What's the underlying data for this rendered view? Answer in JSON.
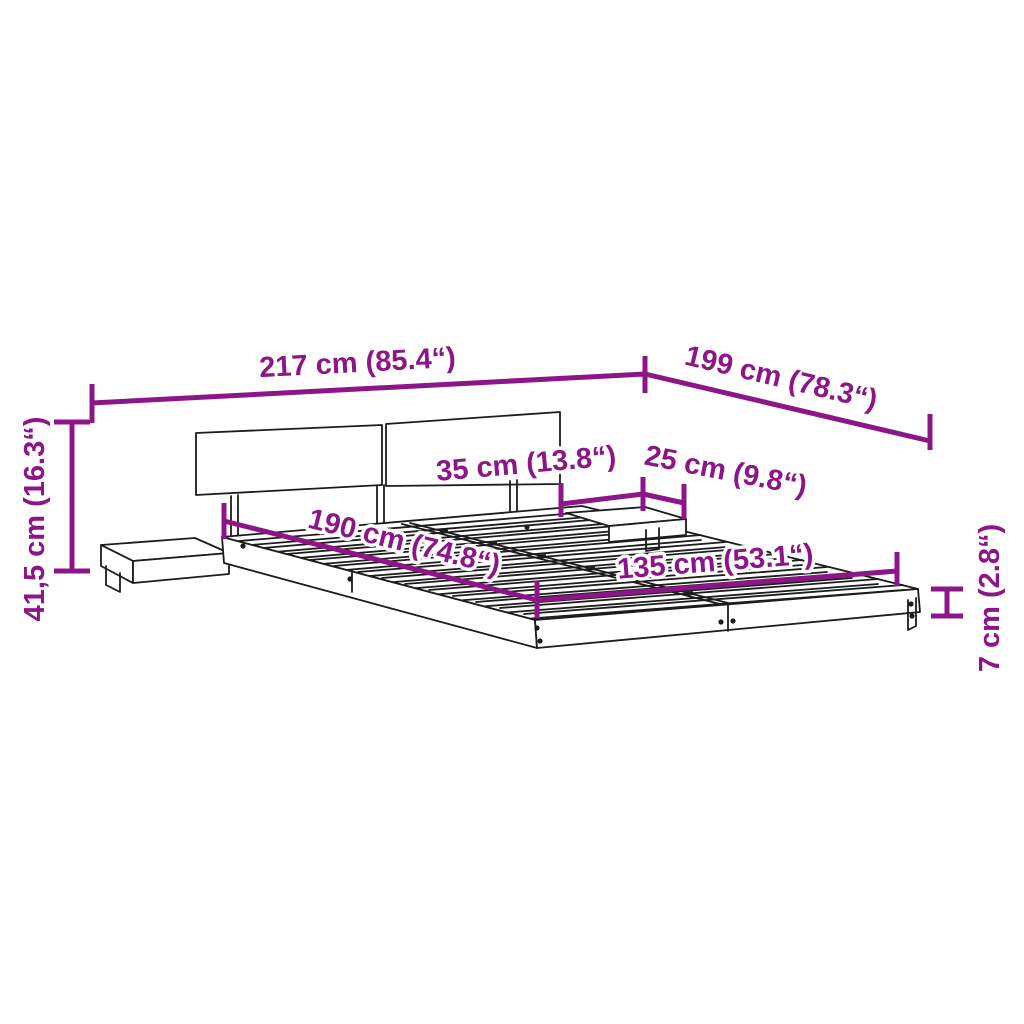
{
  "diagram": {
    "type": "product-dimension-diagram",
    "subject": "bed frame with headboard, slatted base and two floating bedside shelves",
    "accent_color": "#8C1588",
    "line_color": "#1c1c1c",
    "background_color": "#ffffff",
    "dimensions": [
      {
        "id": "total-width",
        "label": "217 cm (85.4“)",
        "value_cm": "217",
        "value_inch": "85.4"
      },
      {
        "id": "total-depth",
        "label": "199 cm (78.3“)",
        "value_cm": "199",
        "value_inch": "78.3"
      },
      {
        "id": "headboard-height",
        "label": "41,5 cm (16.3“)",
        "value_cm": "41,5",
        "value_inch": "16.3"
      },
      {
        "id": "shelf-width",
        "label": "35 cm (13.8“)",
        "value_cm": "35",
        "value_inch": "13.8"
      },
      {
        "id": "shelf-depth",
        "label": "25 cm (9.8“)",
        "value_cm": "25",
        "value_inch": "9.8"
      },
      {
        "id": "bed-length",
        "label": "190 cm (74.8“)",
        "value_cm": "190",
        "value_inch": "74.8"
      },
      {
        "id": "bed-width",
        "label": "135 cm (53.1“)",
        "value_cm": "135",
        "value_inch": "53.1"
      },
      {
        "id": "frame-height",
        "label": "7 cm (2.8“)",
        "value_cm": "7",
        "value_inch": "2.8"
      }
    ]
  }
}
